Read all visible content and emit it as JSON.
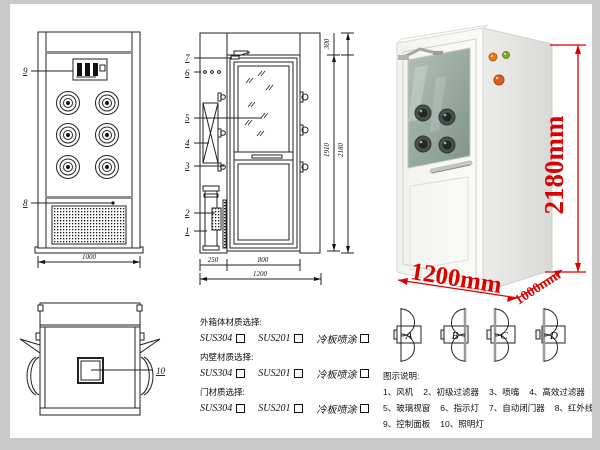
{
  "colors": {
    "accent_red": "#dd0000",
    "line": "#222222",
    "frame_gray": "#c9c9c9"
  },
  "front_view": {
    "callout_control_panel": "9",
    "callout_infrared_sensor": "8",
    "dim_width": "1000"
  },
  "side_view": {
    "callouts": [
      "7",
      "6",
      "5",
      "4",
      "3",
      "2",
      "1"
    ],
    "dim_top": "300",
    "dim_door_height": "1910",
    "dim_total_height": "2180",
    "dim_side": "250",
    "dim_door_width": "800",
    "dim_total_width": "1200"
  },
  "top_view": {
    "callout_lamp": "10"
  },
  "photo": {
    "dim_height": "2180mm",
    "dim_width": "1200mm",
    "dim_depth": "1000mm"
  },
  "door_options": {
    "labels": [
      "A",
      "B",
      "C",
      "D"
    ]
  },
  "materials": {
    "sections": [
      {
        "title": "外箱体材质选择:",
        "options": [
          "SUS304",
          "SUS201",
          "冷板喷涂"
        ]
      },
      {
        "title": "内壁材质选择:",
        "options": [
          "SUS304",
          "SUS201",
          "冷板喷涂"
        ]
      },
      {
        "title": "门材质选择:",
        "options": [
          "SUS304",
          "SUS201",
          "冷板喷涂"
        ]
      }
    ]
  },
  "legend": {
    "title": "图示说明:",
    "items": [
      "1、风机",
      "2、初级过滤器",
      "3、喷嘴",
      "4、高效过滤器",
      "5、玻璃视窗",
      "6、指示灯",
      "7、自动闭门器",
      "8、红外线感应器",
      "9、控制面板",
      "10、照明灯"
    ]
  }
}
